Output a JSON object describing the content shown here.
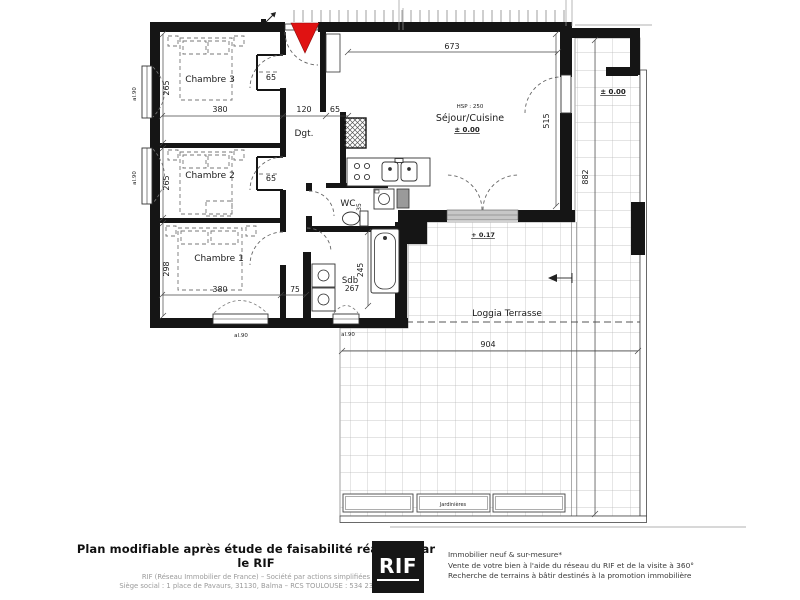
{
  "rooms": {
    "chambre3": "Chambre 3",
    "chambre2": "Chambre 2",
    "chambre1": "Chambre 1",
    "degagement": "Dgt.",
    "wc": "WC",
    "sdb": "Sdb",
    "sejour_cuisine": "Séjour/Cuisine",
    "loggia": "Loggia Terrasse",
    "jardinieres": "Jardinières"
  },
  "dims": {
    "ch3_width": "380",
    "ch3_depth": "265",
    "ch3_closet": "65",
    "entry_width": "120",
    "entry_closet": "65",
    "ch2_depth": "265",
    "ch2_closet": "65",
    "ch1_width": "380",
    "ch1_depth": "298",
    "hall_width": "75",
    "sdb_width": "267",
    "sdb_depth": "245",
    "wc_depth": "35",
    "sejour_width": "673",
    "sejour_depth": "515",
    "terrace_width": "904",
    "terrace_depth": "882"
  },
  "levels": {
    "sejour_level": "± 0.00",
    "sejour_ceiling": "HSP : 250",
    "terrace_level": "± 0.00",
    "loggia_level": "+ 0.17"
  },
  "sill_label": "al.90",
  "footer": {
    "headline": "Plan modifiable après étude de faisabilité réalisée par le RIF",
    "company_line": "RIF (Réseau Immobilier de France) – Société par actions simplifiées",
    "address_line": "Siège social : 1 place de Pavaurs, 31130, Balma – RCS TOULOUSE : 534 234 174",
    "logo_text": "RIF",
    "services": [
      "Immobilier neuf & sur-mesure*",
      "Vente de votre bien à l'aide du réseau du RIF et de la visite à 360°",
      "Recherche de terrains à bâtir destinés à la promotion immobilière"
    ]
  },
  "colors": {
    "wall": "#151515",
    "entry_marker": "#e01212",
    "tile_grid": "#b8b8b8"
  }
}
